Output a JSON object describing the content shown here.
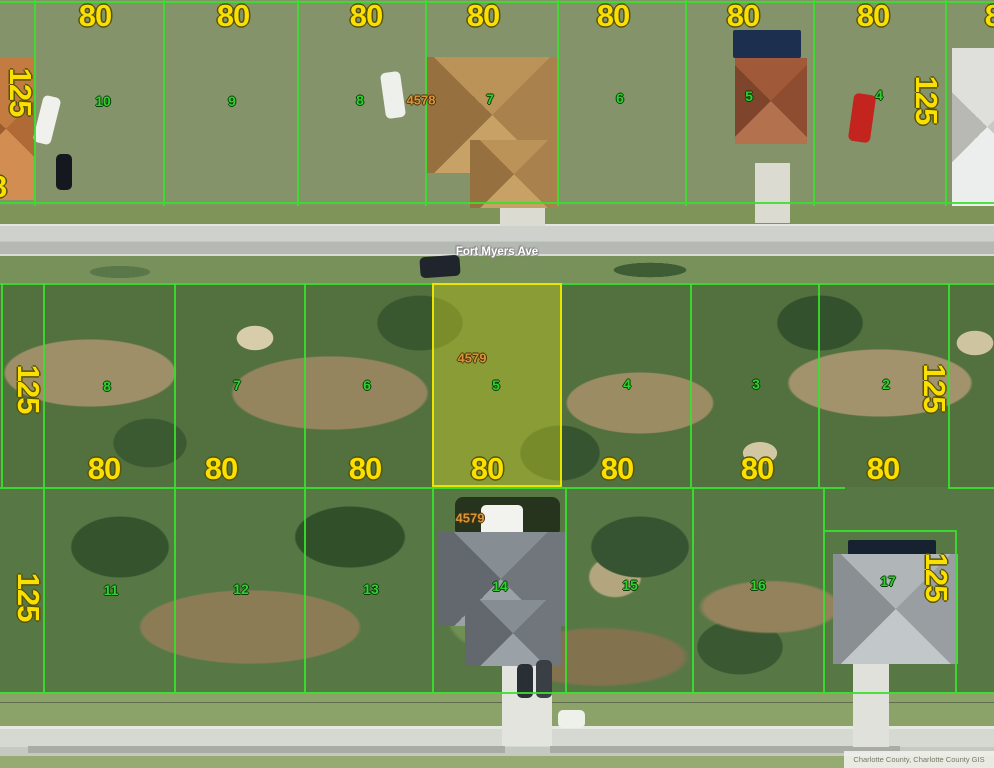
{
  "map": {
    "street_name": "Fort Myers Ave",
    "attribution": "Charlotte County, Charlotte County GIS",
    "highlighted_parcel": {
      "id": "4579",
      "lot_number": "5",
      "frontage_ft": "80",
      "depth_ft": "125"
    },
    "colors": {
      "parcel_line": "#3ae02e",
      "highlight_border": "#e9e400",
      "highlight_fill": "rgba(229,229,38,0.38)",
      "dimension_text": "#fadf00",
      "lot_number_text": "#2fd02f",
      "parcel_id_text": "#d8953b",
      "street_text": "#ffffff"
    },
    "dimension_labels": [
      {
        "text": "80",
        "x": 95,
        "y": 16
      },
      {
        "text": "80",
        "x": 233,
        "y": 16
      },
      {
        "text": "80",
        "x": 366,
        "y": 16
      },
      {
        "text": "80",
        "x": 483,
        "y": 16
      },
      {
        "text": "80",
        "x": 613,
        "y": 16
      },
      {
        "text": "80",
        "x": 743,
        "y": 16
      },
      {
        "text": "80",
        "x": 873,
        "y": 16
      },
      {
        "text": "80",
        "x": 1001,
        "y": 16
      },
      {
        "text": "8",
        "x": -2,
        "y": 187
      },
      {
        "text": "80",
        "x": 104,
        "y": 469
      },
      {
        "text": "80",
        "x": 221,
        "y": 469
      },
      {
        "text": "80",
        "x": 365,
        "y": 469
      },
      {
        "text": "80",
        "x": 487,
        "y": 469
      },
      {
        "text": "80",
        "x": 617,
        "y": 469
      },
      {
        "text": "80",
        "x": 757,
        "y": 469
      },
      {
        "text": "80",
        "x": 883,
        "y": 469
      },
      {
        "text": "125",
        "x": 20,
        "y": 92,
        "rot": 90
      },
      {
        "text": "125",
        "x": 926,
        "y": 100,
        "rot": 90
      },
      {
        "text": "125",
        "x": 28,
        "y": 389,
        "rot": 90
      },
      {
        "text": "125",
        "x": 934,
        "y": 388,
        "rot": 90
      },
      {
        "text": "125",
        "x": 28,
        "y": 597,
        "rot": 90
      },
      {
        "text": "125",
        "x": 936,
        "y": 577,
        "rot": 90
      }
    ],
    "lot_numbers": [
      {
        "text": "10",
        "x": 103,
        "y": 101
      },
      {
        "text": "9",
        "x": 232,
        "y": 101
      },
      {
        "text": "8",
        "x": 360,
        "y": 100
      },
      {
        "text": "7",
        "x": 490,
        "y": 99
      },
      {
        "text": "6",
        "x": 620,
        "y": 98
      },
      {
        "text": "5",
        "x": 749,
        "y": 96
      },
      {
        "text": "4",
        "x": 879,
        "y": 95
      },
      {
        "text": "8",
        "x": 107,
        "y": 386
      },
      {
        "text": "7",
        "x": 237,
        "y": 385
      },
      {
        "text": "6",
        "x": 367,
        "y": 385
      },
      {
        "text": "5",
        "x": 496,
        "y": 385
      },
      {
        "text": "4",
        "x": 627,
        "y": 384
      },
      {
        "text": "3",
        "x": 756,
        "y": 384
      },
      {
        "text": "2",
        "x": 886,
        "y": 384
      },
      {
        "text": "11",
        "x": 111,
        "y": 590
      },
      {
        "text": "12",
        "x": 241,
        "y": 589
      },
      {
        "text": "13",
        "x": 371,
        "y": 589
      },
      {
        "text": "14",
        "x": 500,
        "y": 586
      },
      {
        "text": "15",
        "x": 630,
        "y": 585
      },
      {
        "text": "16",
        "x": 758,
        "y": 585
      },
      {
        "text": "17",
        "x": 888,
        "y": 581
      }
    ],
    "parcel_ids": [
      {
        "text": "4578",
        "x": 421,
        "y": 100
      },
      {
        "text": "4579",
        "x": 472,
        "y": 358
      },
      {
        "text": "4579",
        "x": 470,
        "y": 518
      }
    ]
  }
}
